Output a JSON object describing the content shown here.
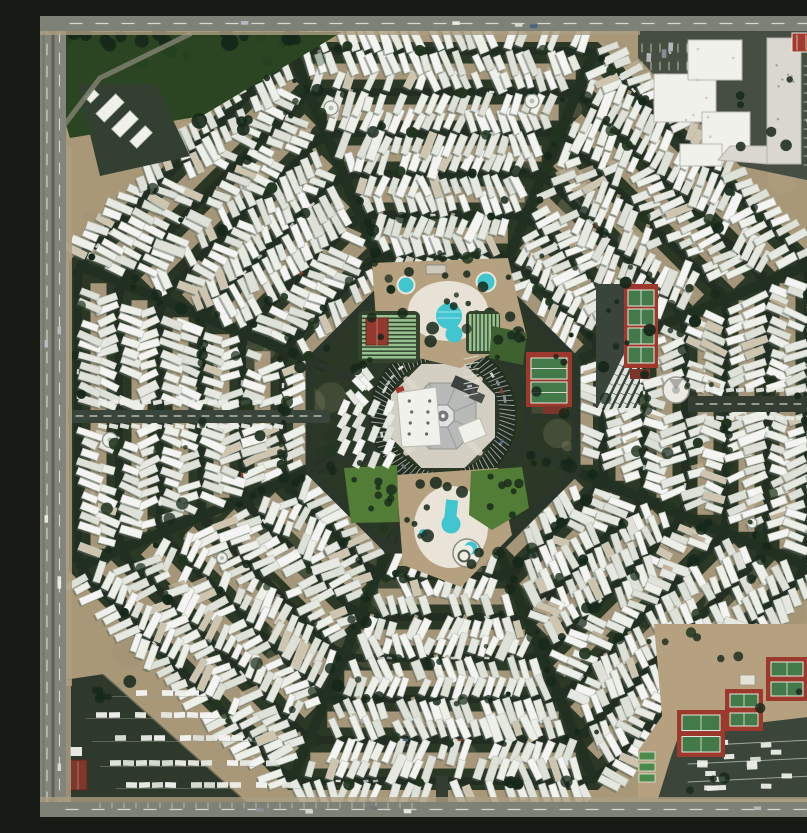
{
  "meta": {
    "title": "Aerial photograph of an octagonal trailer-park community",
    "description": "Top-down satellite photograph of a mobile-home park laid out as a giant octagonal spiderweb: concentric octagon rings of white trailers around a central octagonal clubhouse plaza, two swimming pools, lawns, shuffleboard lanes and red tennis courts, bordered by a highway on the west, roads on all edges, a white commercial complex in the northeast corner, an RV storage lot in the southwest corner and a tennis complex with parking in the southeast corner."
  },
  "canvas": {
    "width": 807,
    "height": 801
  },
  "palette": {
    "ground": "#a89878",
    "octagon": "#2c3826",
    "street": "#232e22",
    "alley": "#b2a183",
    "highway": "#83857b",
    "road": "#7e8176",
    "road_dark": "#565e50",
    "lane": "#e6e7de",
    "curb": "#aa9d81",
    "trailer_whites": [
      "#f4f5f2",
      "#edefe9",
      "#e6e9e2",
      "#dde1d8"
    ],
    "trailer_beige": "#cfc5ae",
    "trailer_shadow": "#59655c",
    "trailer_edge": "#c6cbc2",
    "awning": "#b9a98d",
    "tree_dark": "#16281a",
    "tree_mid": "#21351f",
    "shrub": "#2c4426",
    "park_lawn": "#2b4522",
    "lawn_bright": "#527d36",
    "lawn_dark": "#3f6130",
    "pool": "#41c6d0",
    "deck": "#eae6da",
    "dirt": "#b5a17f",
    "court_red": "#9c382c",
    "court_green": "#44794a",
    "court_line": "#e2e8dc",
    "maroon": "#7c352a",
    "shuffle_base": "#33432c",
    "shuffle_green": "#9cc795",
    "plaza": "#d3cfc2",
    "roof": "#b7bab7",
    "roof_edge": "#94978f",
    "white_bldg": "#f1f1ec",
    "bldg_edge": "#b9b9b0",
    "red_roof": "#a23a2e",
    "gray_bldg": "#d9d7d0",
    "parking": "#464e42",
    "stall": "#d6d8d0",
    "car_colors": [
      "#eceee8",
      "#d9dbd5",
      "#b9bdc2",
      "#8b9097",
      "#70757c",
      "#8a3b30",
      "#46617e"
    ]
  },
  "geometry": {
    "center": [
      403,
      400
    ],
    "ring_apothems": [
      160,
      201,
      242,
      283,
      324,
      365
    ],
    "row_offset": 12,
    "trailer_step": 10.6,
    "trailer_len": [
      14,
      6
    ],
    "trailer_wid": [
      6,
      2
    ],
    "sectors": 8,
    "seam_offset_deg": 22.5,
    "seed": 987654321,
    "amenity_ring_apothem": 133,
    "alley_ring_apothem": 142,
    "hub_ring_r": 85
  },
  "features": {
    "hub": {
      "plaza_apothem": 52,
      "roof_apothem": 33,
      "core_apothem": 11,
      "park_r1": 57,
      "park_r2": 72
    },
    "north_pool": {
      "lot": [
        [
          332,
          247
        ],
        [
          468,
          242
        ],
        [
          487,
          322
        ],
        [
          420,
          352
        ],
        [
          338,
          332
        ]
      ],
      "deck": [
        408,
        295,
        40,
        30
      ],
      "small_pools": [
        [
          366,
          269,
          7.5
        ],
        [
          446,
          266,
          8.5
        ]
      ],
      "main_pool": [
        409,
        300,
        13
      ],
      "lobe": [
        414,
        318,
        8.5
      ],
      "building": [
        386,
        249,
        20,
        9
      ]
    },
    "south_pool": {
      "lot": [
        [
          356,
          459
        ],
        [
          458,
          452
        ],
        [
          472,
          519
        ],
        [
          421,
          571
        ],
        [
          363,
          549
        ]
      ],
      "deck": [
        411,
        511,
        37,
        41
      ],
      "keyhole_circle": [
        411,
        508,
        9.5
      ],
      "keyhole_neck": [
        405,
        484,
        12,
        22
      ],
      "spiral": [
        427,
        537,
        14
      ],
      "crescent": [
        431,
        532,
        6.5
      ],
      "dots": [
        [
          383,
          517,
          4
        ],
        [
          443,
          501,
          3
        ]
      ]
    },
    "shuffleboard_nw": {
      "base": [
        318,
        295,
        62,
        52
      ],
      "lanes": 11,
      "building": [
        326,
        302,
        22,
        27
      ]
    },
    "shuffleboard_ne": {
      "base": [
        426,
        295,
        34,
        43
      ],
      "lanes": 8
    },
    "lawn_ne": [
      [
        452,
        310
      ],
      [
        487,
        317
      ],
      [
        483,
        349
      ],
      [
        449,
        342
      ]
    ],
    "lawn_se": [
      [
        431,
        455
      ],
      [
        482,
        451
      ],
      [
        489,
        492
      ],
      [
        452,
        514
      ],
      [
        429,
        499
      ]
    ],
    "lawn_sw": [
      [
        304,
        452
      ],
      [
        357,
        449
      ],
      [
        359,
        506
      ],
      [
        311,
        507
      ]
    ],
    "tennis_east": {
      "pad": [
        486,
        336,
        46,
        55
      ],
      "courts": [
        [
          491,
          342,
          36,
          21
        ],
        [
          491,
          366,
          36,
          21
        ]
      ],
      "shed": [
        503,
        390,
        24,
        8
      ]
    },
    "pickleball_east": {
      "pad": [
        584,
        268,
        34,
        84
      ],
      "courts": [
        [
          588,
          274,
          26,
          16
        ],
        [
          588,
          293,
          26,
          16
        ],
        [
          588,
          312,
          26,
          16
        ],
        [
          588,
          331,
          26,
          16
        ]
      ],
      "shed": [
        590,
        353,
        20,
        10
      ]
    },
    "storage_yard": {
      "poly": [
        [
          556,
          268
        ],
        [
          600,
          268
        ],
        [
          600,
          392
        ],
        [
          556,
          392
        ]
      ],
      "rows": 6,
      "row_angle": -64
    },
    "round_building": [
      636,
      374,
      13
    ],
    "culdesac_circles": [
      [
        291,
        92,
        7
      ],
      [
        492,
        85,
        7
      ],
      [
        70,
        424,
        7.5
      ],
      [
        182,
        542,
        5.5
      ],
      [
        630,
        627,
        5.5
      ],
      [
        712,
        507,
        5
      ]
    ],
    "entrance_east": {
      "road": [
        648,
        380,
        140,
        16
      ]
    },
    "entrance_west": {
      "road": [
        28,
        394,
        262,
        13
      ]
    },
    "stub_south": [
      396,
      760,
      12,
      30
    ],
    "corner_nw": {
      "lawn": [
        [
          12,
          16
        ],
        [
          302,
          16
        ],
        [
          162,
          100
        ],
        [
          30,
          122
        ],
        [
          12,
          62
        ]
      ],
      "yard": [
        [
          38,
          68
        ],
        [
          116,
          68
        ],
        [
          150,
          140
        ],
        [
          60,
          160
        ]
      ],
      "buildings": [
        [
          56,
          86,
          28,
          12
        ],
        [
          72,
          102,
          26,
          12
        ],
        [
          90,
          116,
          22,
          10
        ],
        [
          46,
          76,
          12,
          8
        ]
      ],
      "access_road": [
        [
          150,
          18
        ],
        [
          60,
          62
        ],
        [
          22,
          112
        ]
      ]
    },
    "corner_ne": {
      "parking": [
        [
          598,
          15
        ],
        [
          786,
          15
        ],
        [
          786,
          168
        ],
        [
          700,
          150
        ],
        [
          598,
          42
        ]
      ],
      "main_building": [
        [
          614,
          58,
          62,
          48
        ],
        [
          648,
          24,
          54,
          40
        ],
        [
          662,
          96,
          48,
          42
        ],
        [
          640,
          128,
          42,
          22
        ]
      ],
      "long_building": [
        727,
        22,
        34,
        126
      ],
      "long_building_foot": [
        [
          690,
          130
        ],
        [
          727,
          130
        ],
        [
          727,
          148
        ],
        [
          678,
          144
        ]
      ],
      "red_building": [
        752,
        17,
        31,
        19
      ],
      "east_parking": [
        762,
        44,
        26,
        112
      ]
    },
    "corner_sw": {
      "lot": [
        [
          24,
          664
        ],
        [
          64,
          658
        ],
        [
          210,
          788
        ],
        [
          24,
          788
        ]
      ],
      "rv_rows": [
        [
          70,
          677,
          160
        ],
        [
          56,
          699,
          180
        ],
        [
          62,
          722,
          205
        ],
        [
          70,
          747,
          228
        ],
        [
          86,
          769,
          252
        ]
      ],
      "red_building": [
        30,
        744,
        17,
        30
      ],
      "shed": [
        30,
        731,
        12,
        9
      ]
    },
    "corner_se": {
      "ground": [
        [
          614,
          608
        ],
        [
          788,
          608
        ],
        [
          788,
          786
        ],
        [
          598,
          786
        ],
        [
          598,
          735
        ],
        [
          622,
          700
        ]
      ],
      "pads": [
        [
          726,
          641,
          42,
          44
        ],
        [
          685,
          673,
          38,
          42
        ],
        [
          637,
          694,
          48,
          47
        ]
      ],
      "mini_courts": [
        [
          599,
          736,
          16,
          8
        ],
        [
          599,
          747,
          16,
          8
        ],
        [
          599,
          758,
          16,
          8
        ]
      ],
      "parking": [
        [
          640,
          716
        ],
        [
          777,
          700
        ],
        [
          786,
          722
        ],
        [
          786,
          783
        ],
        [
          618,
          783
        ],
        [
          631,
          741
        ]
      ],
      "shed": [
        700,
        659,
        15,
        10
      ]
    },
    "roads": {
      "west": [
        0,
        0,
        26,
        801
      ],
      "north": [
        0,
        0,
        807,
        15
      ],
      "south": [
        0,
        786,
        807,
        15
      ],
      "east": [
        786,
        0,
        21,
        801
      ]
    }
  }
}
